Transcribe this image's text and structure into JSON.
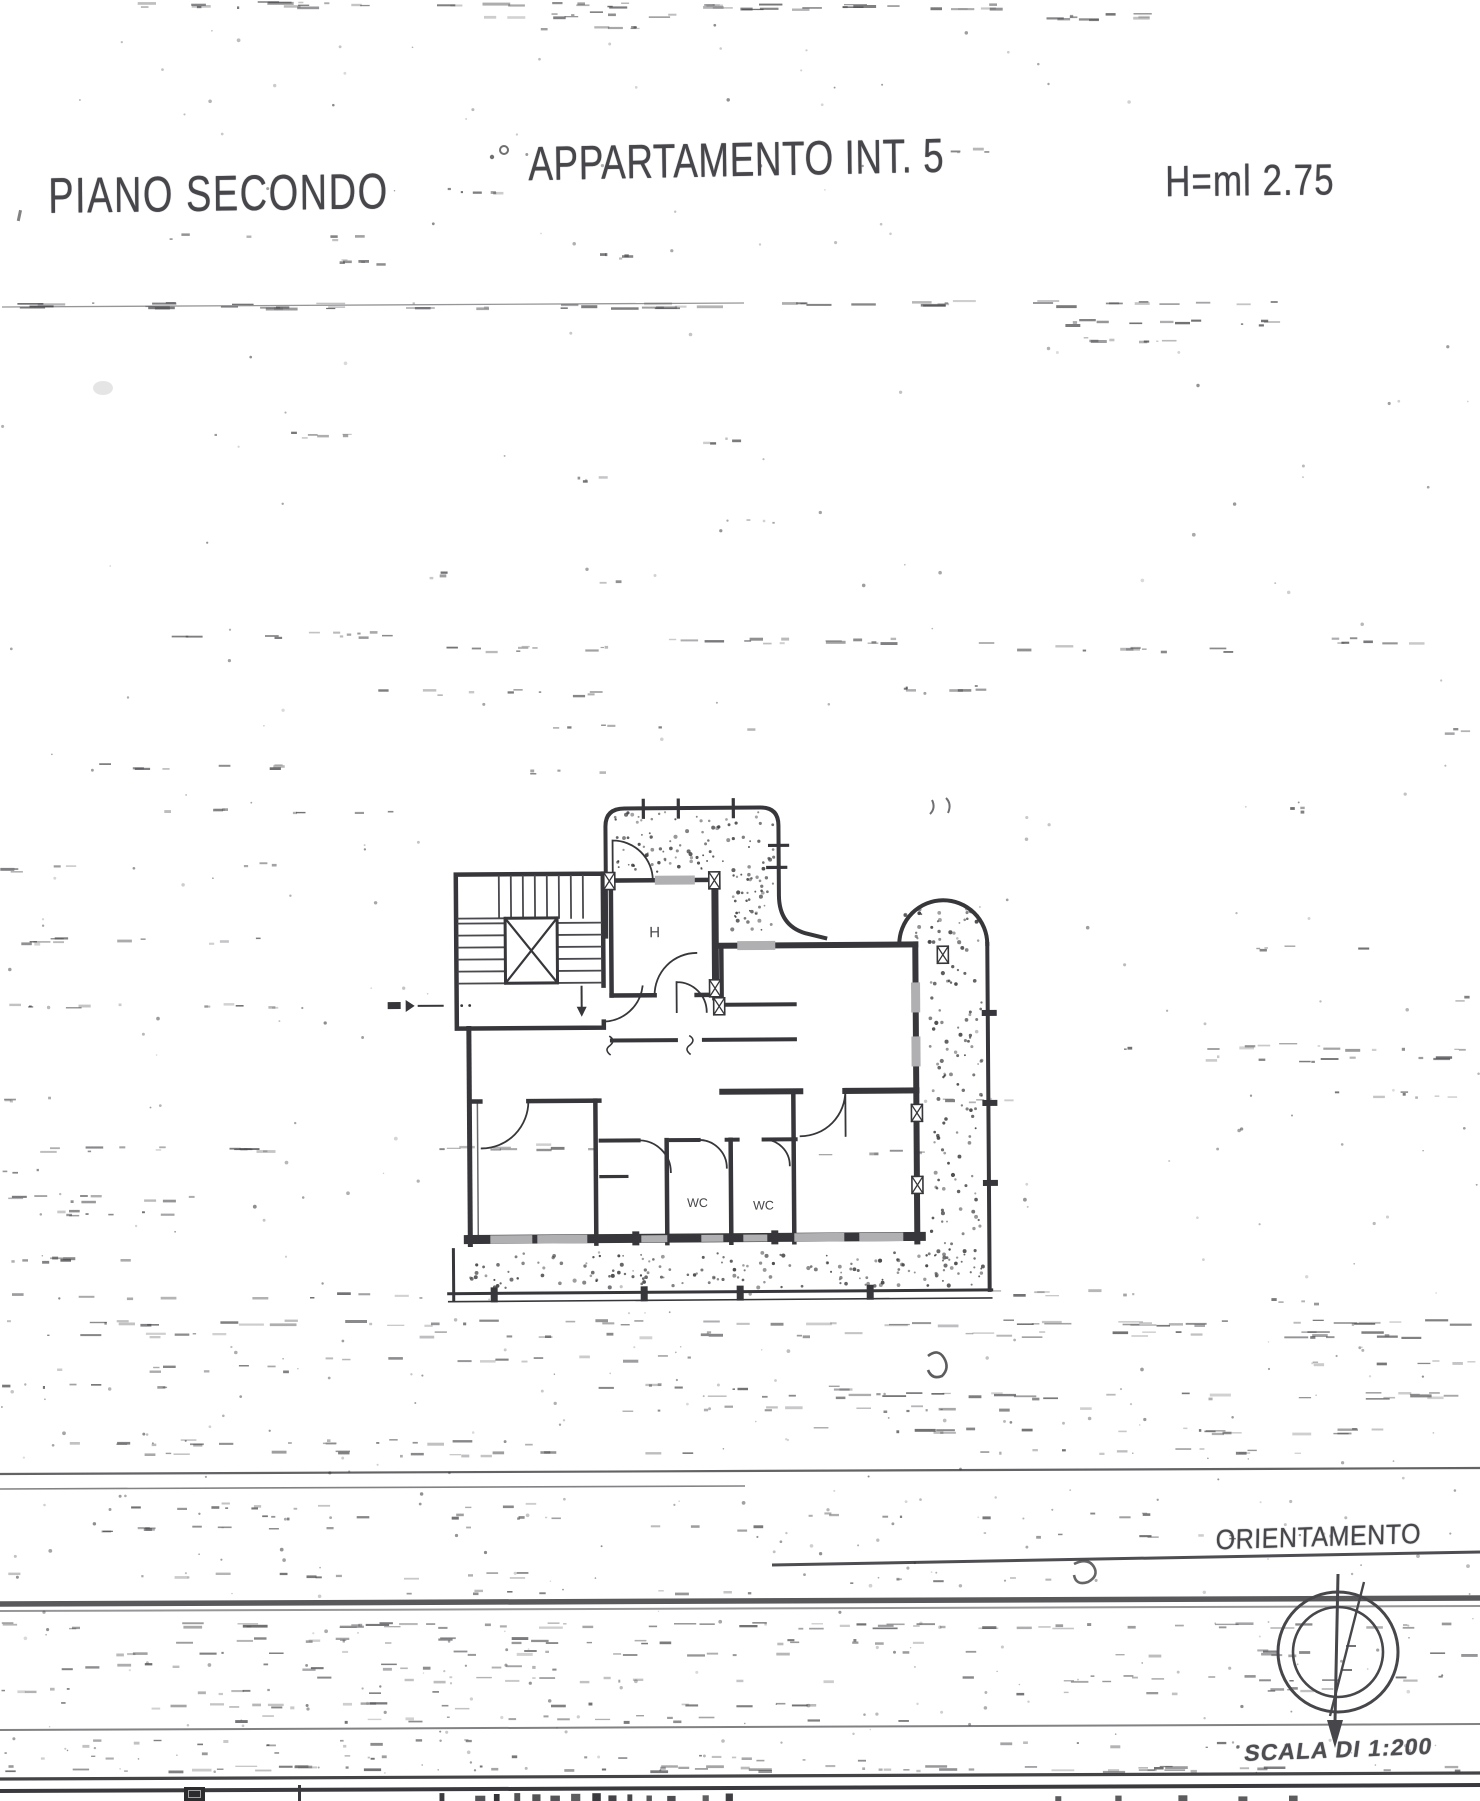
{
  "header": {
    "floor": "PIANO SECONDO",
    "apartment": "APPARTAMENTO INT. 5",
    "height": "H=ml 2.75"
  },
  "plan": {
    "rooms": [
      {
        "label": "H"
      },
      {
        "label": "WC"
      },
      {
        "label": "WC"
      }
    ]
  },
  "footer": {
    "orientation": "ORIENTAMENTO",
    "scale": "SCALA DI 1:200"
  },
  "colors": {
    "ink": "#37373b",
    "noise": "#4c4c50",
    "paper": "#ffffff"
  }
}
